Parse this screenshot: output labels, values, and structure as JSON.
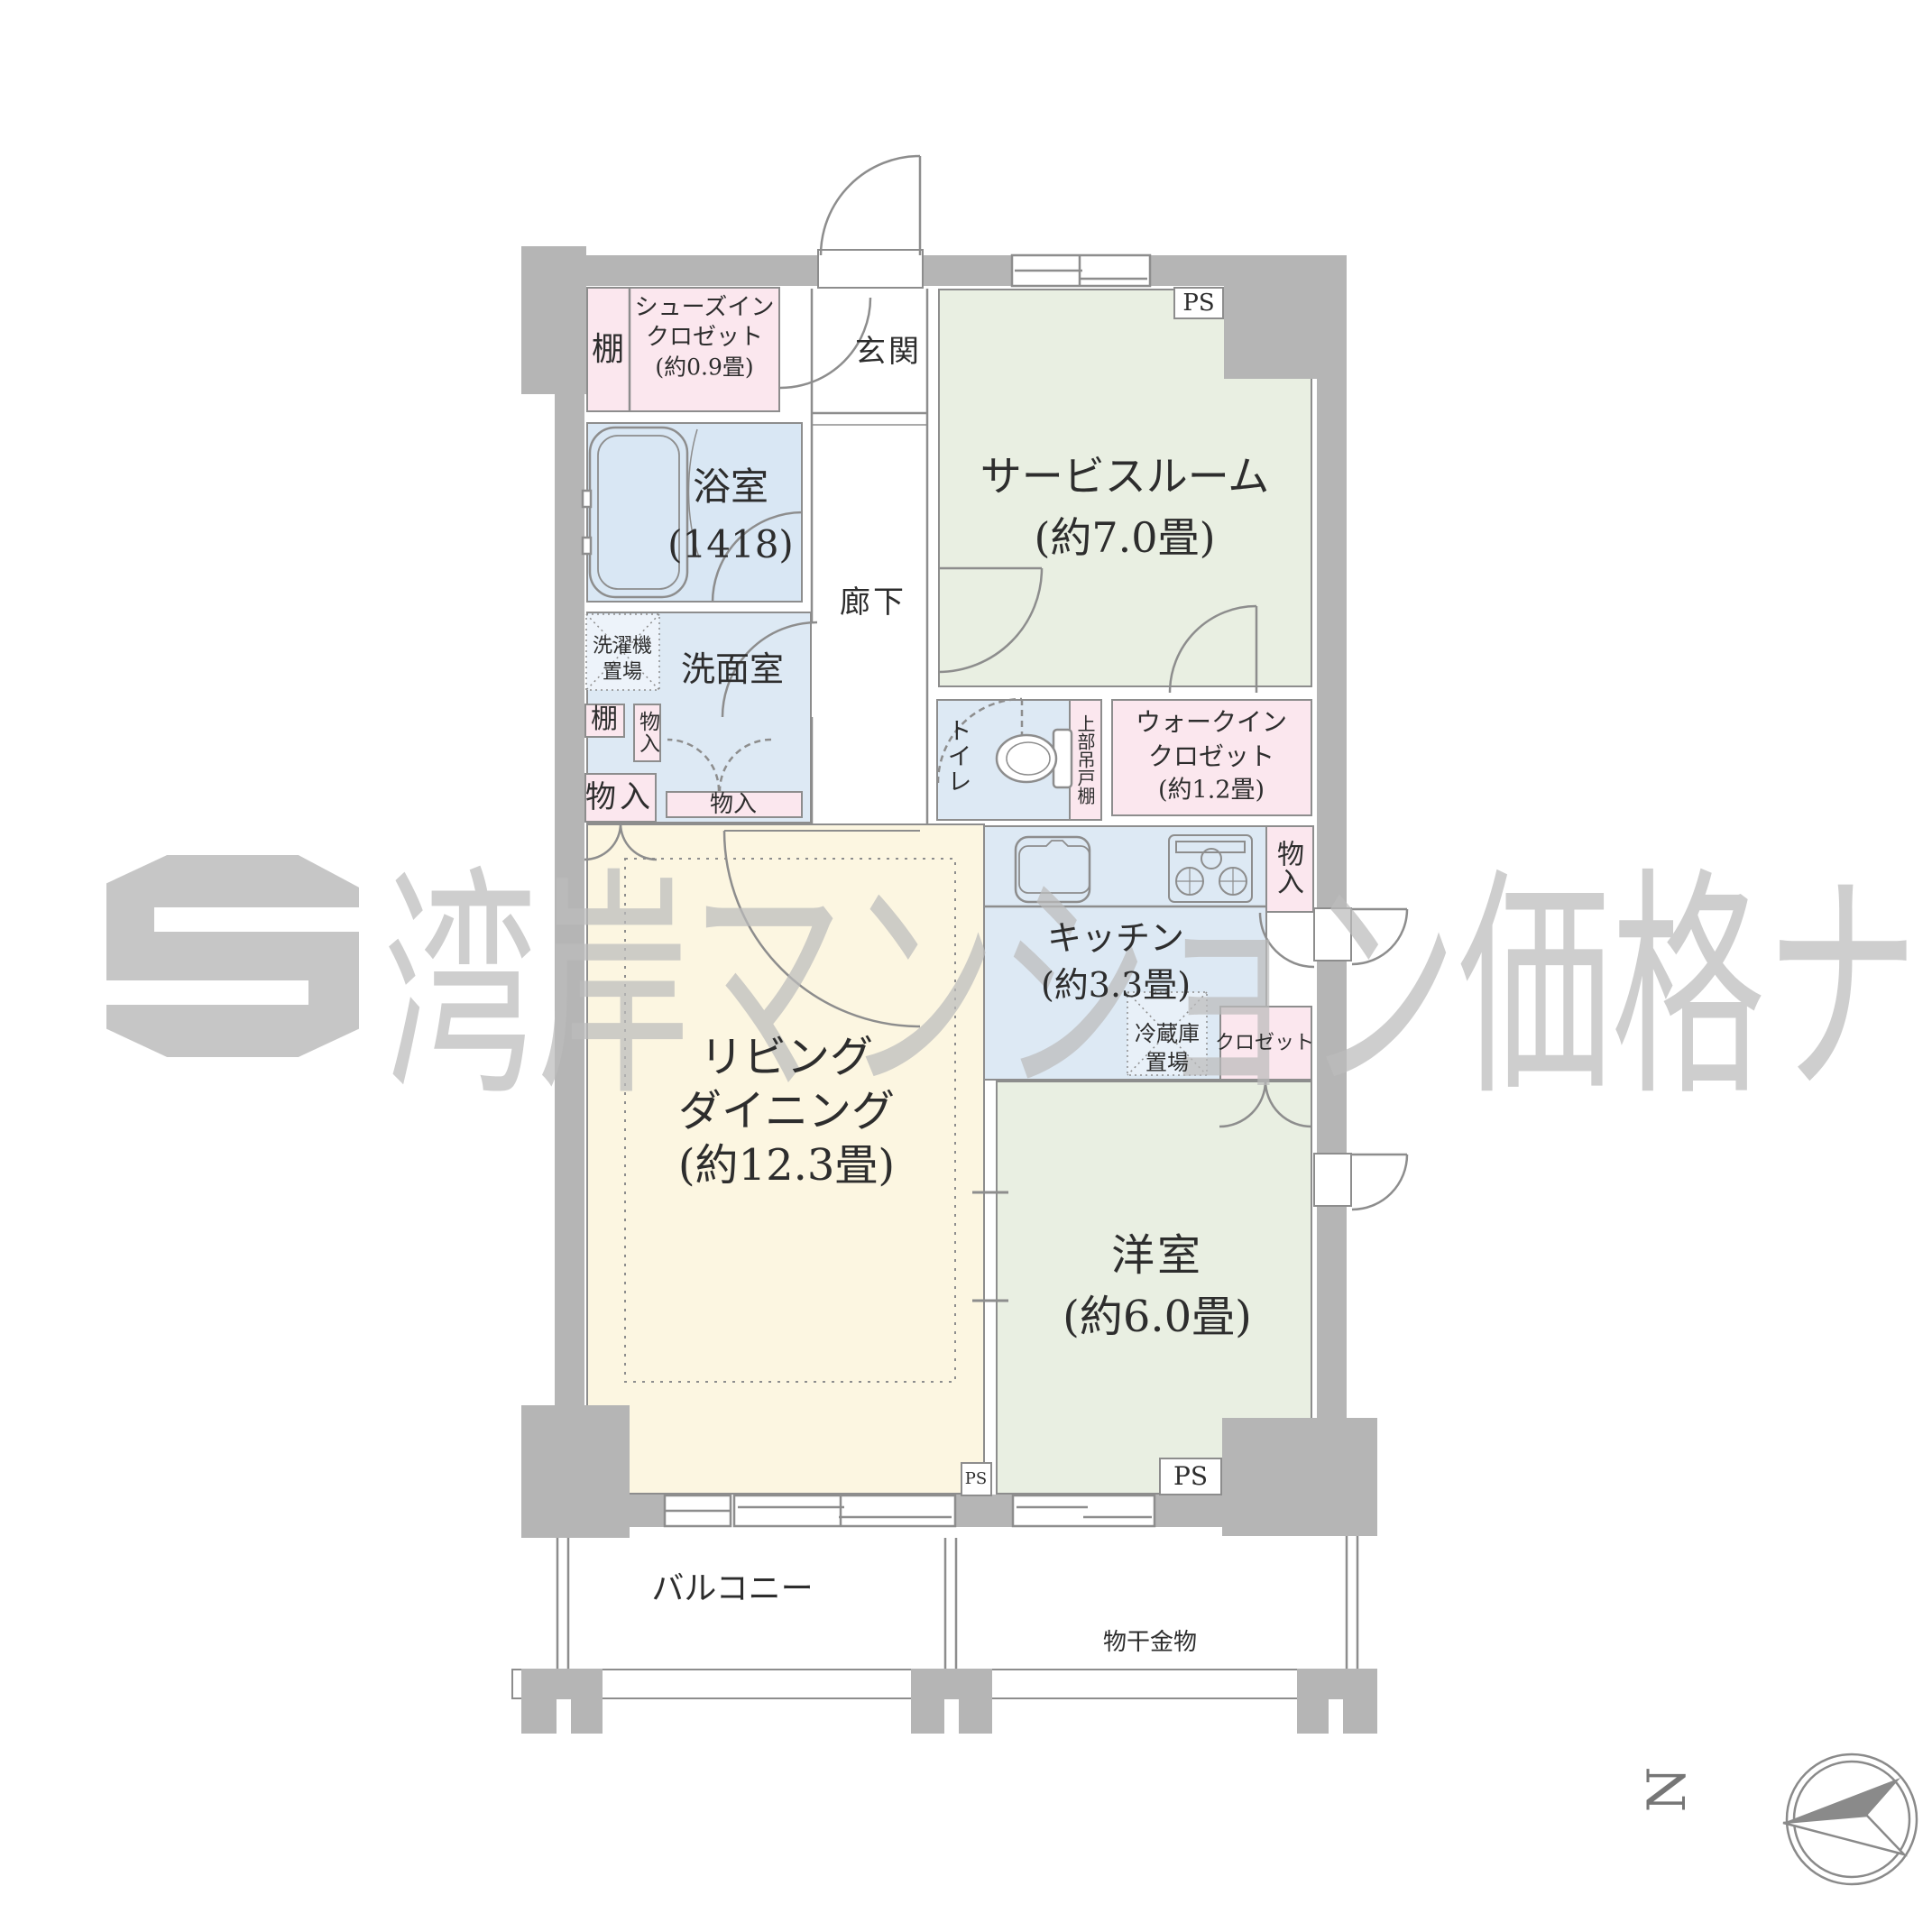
{
  "title": "マンション間取り図 (2SLDK相当・専有部プラン)",
  "watermark": {
    "text": "湾岸マンション価格ナビ"
  },
  "compass": {
    "north_label": "N"
  },
  "colors": {
    "wall_gray": "#b5b5b5",
    "line_gray": "#8d8d8d",
    "room_green": "#e9efe2",
    "room_cream": "#fcf6e1",
    "room_blue": "#dde9f4",
    "room_pink": "#fbe7ee",
    "hatch_blue": "#edf3fa",
    "watermark_gray": "#bcbcbc",
    "text_dark": "#2d2d2d"
  },
  "rooms": [
    {
      "name": "サービスルーム",
      "size": "(約7.0畳)"
    },
    {
      "name": "リビングダイニング",
      "size": "(約12.3畳)"
    },
    {
      "name": "洋室",
      "size": "(約6.0畳)"
    },
    {
      "name": "キッチン",
      "size": "(約3.3畳)"
    },
    {
      "name": "浴室",
      "size": "(1418)"
    },
    {
      "name": "シューズインクロゼット",
      "size": "(約0.9畳)"
    },
    {
      "name": "ウォークインクロゼット",
      "size": "(約1.2畳)"
    }
  ],
  "labels": {
    "shoes_closet_line1": "シューズイン",
    "shoes_closet_line2": "クロゼット",
    "shoes_closet_line3": "(約0.9畳)",
    "sic_shelf": "棚",
    "genkan": "玄関",
    "service_room": "サービスルーム",
    "service_room_size": "(約7.0畳)",
    "ps_top": "PS",
    "ps_living": "PS",
    "ps_bedroom": "PS",
    "bathroom": "浴室",
    "bathroom_size": "(1418)",
    "hallway": "廊下",
    "laundry_line1": "洗濯機",
    "laundry_line2": "置場",
    "washroom": "洗面室",
    "shelf": "棚",
    "storage_a": "物入",
    "storage_b": "物入",
    "storage_c": "物入",
    "storage_kitchen": "物入",
    "toilet": "トイレ",
    "upper_cabinet": "上部吊戸棚",
    "wic_line1": "ウォークイン",
    "wic_line2": "クロゼット",
    "wic_line3": "(約1.2畳)",
    "kitchen": "キッチン",
    "kitchen_size": "(約3.3畳)",
    "fridge_line1": "冷蔵庫",
    "fridge_line2": "置場",
    "closet": "クロゼット",
    "living_line1": "リビング",
    "living_line2": "ダイニング",
    "living_line3": "(約12.3畳)",
    "bedroom": "洋室",
    "bedroom_size": "(約6.0畳)",
    "balcony": "バルコニー",
    "drying_fixture": "物干金物",
    "compass_north": "N",
    "watermark": "湾岸マンション価格ナビ"
  }
}
